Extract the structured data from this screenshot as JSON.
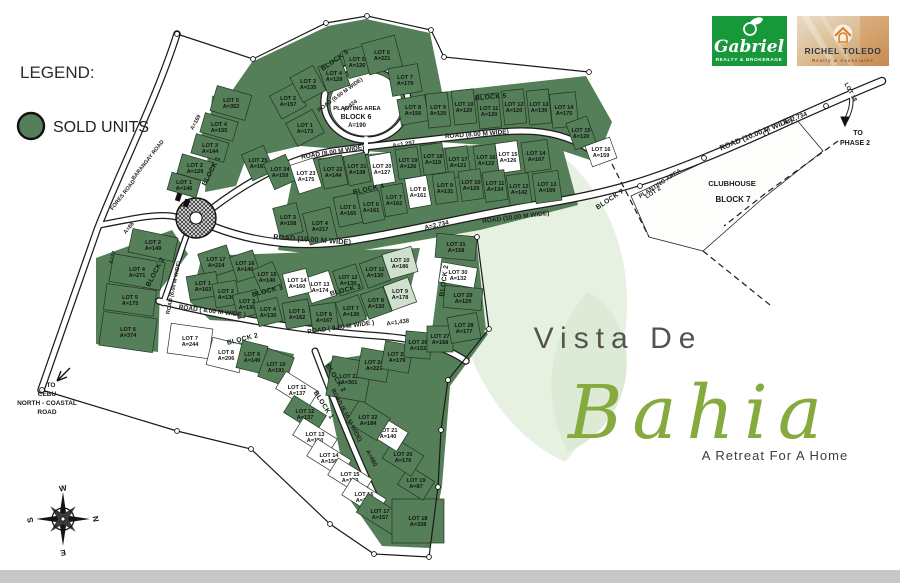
{
  "legend": {
    "title": "LEGEND:",
    "sold_label": "SOLD UNITS"
  },
  "branding": {
    "gabriel_name": "Gabriel",
    "gabriel_tagline": "REALTY & BROKERAGE",
    "richel_name": "RICHEL TOLEDO",
    "richel_tagline": "Realty & Associates"
  },
  "title": {
    "prefix": "Vista De",
    "name": "Bahia",
    "tagline": "A Retreat For A Home"
  },
  "compass": {
    "n": "N",
    "e": "E",
    "s": "S",
    "w": "W"
  },
  "colors": {
    "sold": "#547f58",
    "pale": "#cfe0cc",
    "open": "#ffffff",
    "leaf": "#e3eedd",
    "gabriel_green": "#17993b",
    "road_casing": "#1c1c1c",
    "title_gray": "#57524d",
    "title_green": "#85aa3e"
  },
  "map": {
    "blocks": [
      {
        "id": "block-5",
        "lots": [
          [
            1,
            173,
            305,
            128,
            1,
            30,
            26,
            -28
          ],
          [
            2,
            157,
            288,
            101,
            1,
            28,
            26,
            -28
          ],
          [
            3,
            135,
            308,
            84,
            1,
            26,
            28,
            -28
          ],
          [
            4,
            129,
            334,
            76,
            1,
            24,
            28,
            -20
          ],
          [
            5,
            126,
            357,
            62,
            1,
            24,
            28,
            -15
          ],
          [
            6,
            221,
            382,
            55,
            1,
            34,
            32,
            -15
          ],
          [
            7,
            179,
            405,
            80,
            1,
            30,
            28,
            -10
          ],
          [
            8,
            156,
            413,
            110,
            1,
            28,
            26,
            -10
          ],
          [
            9,
            120,
            438,
            110,
            1,
            22,
            34,
            -6
          ],
          [
            10,
            120,
            464,
            107,
            1,
            22,
            34,
            -6
          ],
          [
            11,
            120,
            489,
            111,
            1,
            22,
            34,
            -6
          ],
          [
            12,
            120,
            514,
            107,
            1,
            22,
            34,
            -6
          ],
          [
            13,
            130,
            539,
            107,
            1,
            22,
            34,
            -6
          ],
          [
            14,
            175,
            564,
            110,
            1,
            26,
            34,
            -6
          ],
          [
            15,
            120,
            581,
            133,
            1,
            22,
            28,
            -20
          ],
          [
            16,
            159,
            601,
            152,
            0,
            26,
            22,
            -20
          ]
        ]
      },
      {
        "id": "block-4",
        "lots": [
          [
            25,
            161,
            258,
            163,
            1,
            24,
            28,
            -24
          ],
          [
            24,
            159,
            280,
            172,
            1,
            24,
            28,
            -24
          ],
          [
            23,
            175,
            306,
            176,
            0,
            24,
            30,
            -18
          ],
          [
            22,
            144,
            333,
            172,
            1,
            24,
            30,
            -12
          ],
          [
            21,
            138,
            357,
            169,
            1,
            22,
            30,
            -12
          ],
          [
            20,
            127,
            382,
            169,
            0,
            22,
            30,
            -10
          ],
          [
            19,
            126,
            408,
            163,
            1,
            22,
            30,
            -8
          ],
          [
            18,
            119,
            433,
            159,
            1,
            22,
            30,
            -8
          ],
          [
            17,
            121,
            458,
            162,
            1,
            22,
            30,
            -8
          ],
          [
            16,
            122,
            486,
            160,
            1,
            22,
            30,
            -8
          ],
          [
            15,
            126,
            508,
            157,
            0,
            22,
            30,
            -8
          ],
          [
            14,
            167,
            536,
            156,
            1,
            26,
            30,
            -8
          ],
          [
            3,
            158,
            288,
            220,
            1,
            24,
            30,
            -14
          ],
          [
            4,
            217,
            320,
            226,
            1,
            28,
            32,
            -14
          ],
          [
            5,
            165,
            348,
            210,
            1,
            24,
            30,
            -12
          ],
          [
            6,
            161,
            371,
            207,
            1,
            22,
            30,
            -12
          ],
          [
            7,
            162,
            394,
            200,
            1,
            22,
            30,
            -10
          ],
          [
            8,
            161,
            418,
            192,
            0,
            22,
            30,
            -10
          ],
          [
            9,
            131,
            445,
            188,
            1,
            22,
            30,
            -8
          ],
          [
            10,
            129,
            471,
            185,
            1,
            22,
            30,
            -8
          ],
          [
            11,
            134,
            495,
            186,
            1,
            22,
            30,
            -8
          ],
          [
            12,
            142,
            519,
            189,
            1,
            22,
            30,
            -8
          ],
          [
            13,
            169,
            547,
            187,
            1,
            26,
            30,
            -8
          ]
        ]
      },
      {
        "id": "block-1",
        "lots": [
          [
            5,
            352,
            231,
            103,
            1,
            36,
            26,
            16
          ],
          [
            4,
            155,
            219,
            127,
            1,
            34,
            20,
            16
          ],
          [
            3,
            144,
            210,
            148,
            1,
            34,
            20,
            16
          ],
          [
            2,
            129,
            195,
            168,
            1,
            32,
            20,
            16
          ],
          [
            1,
            146,
            184,
            185,
            1,
            30,
            18,
            16
          ]
        ]
      },
      {
        "id": "block-3",
        "lots": [
          [
            17,
            214,
            216,
            262,
            1,
            30,
            26,
            -18
          ],
          [
            16,
            140,
            245,
            266,
            1,
            24,
            26,
            -18
          ],
          [
            15,
            140,
            267,
            277,
            1,
            22,
            24,
            -24
          ],
          [
            1,
            163,
            203,
            286,
            1,
            30,
            24,
            -10
          ],
          [
            2,
            130,
            226,
            294,
            1,
            24,
            24,
            -10
          ],
          [
            3,
            130,
            247,
            304,
            1,
            24,
            24,
            -14
          ],
          [
            4,
            130,
            268,
            312,
            1,
            24,
            24,
            -14
          ],
          [
            5,
            162,
            297,
            314,
            1,
            26,
            26,
            -10
          ],
          [
            6,
            167,
            324,
            317,
            1,
            26,
            26,
            -8
          ],
          [
            7,
            130,
            351,
            311,
            1,
            24,
            26,
            -20
          ],
          [
            8,
            130,
            376,
            303,
            1,
            24,
            26,
            -20
          ],
          [
            9,
            178,
            400,
            294,
            2,
            26,
            26,
            -20
          ],
          [
            10,
            186,
            400,
            263,
            2,
            30,
            26,
            -16
          ],
          [
            11,
            130,
            375,
            272,
            1,
            24,
            26,
            -20
          ],
          [
            12,
            130,
            348,
            280,
            1,
            24,
            26,
            -18
          ],
          [
            13,
            174,
            320,
            287,
            0,
            26,
            26,
            -18
          ],
          [
            14,
            160,
            297,
            283,
            0,
            24,
            24,
            -14
          ]
        ]
      },
      {
        "id": "block-2",
        "lots": [
          [
            2,
            149,
            153,
            245,
            1,
            46,
            24,
            12
          ],
          [
            4,
            271,
            137,
            272,
            1,
            52,
            28,
            10
          ],
          [
            5,
            175,
            130,
            300,
            1,
            50,
            26,
            8
          ],
          [
            6,
            374,
            128,
            332,
            1,
            54,
            34,
            8
          ],
          [
            7,
            244,
            190,
            341,
            0,
            42,
            30,
            8
          ],
          [
            8,
            206,
            226,
            355,
            0,
            34,
            28,
            14
          ],
          [
            9,
            140,
            252,
            357,
            1,
            26,
            28,
            14
          ],
          [
            10,
            191,
            276,
            367,
            1,
            28,
            30,
            20
          ],
          [
            11,
            137,
            297,
            390,
            0,
            38,
            20,
            32
          ],
          [
            12,
            137,
            305,
            414,
            1,
            38,
            20,
            32
          ],
          [
            13,
            150,
            315,
            437,
            0,
            40,
            20,
            32
          ],
          [
            14,
            156,
            329,
            458,
            0,
            40,
            20,
            32
          ],
          [
            15,
            153,
            350,
            477,
            0,
            40,
            20,
            32
          ],
          [
            16,
            157,
            364,
            497,
            0,
            40,
            20,
            32
          ],
          [
            17,
            157,
            380,
            514,
            1,
            42,
            22,
            32
          ],
          [
            18,
            328,
            418,
            521,
            1,
            52,
            44,
            0
          ],
          [
            19,
            87,
            416,
            483,
            1,
            30,
            22,
            32
          ],
          [
            20,
            176,
            403,
            457,
            1,
            34,
            24,
            32
          ],
          [
            21,
            140,
            388,
            433,
            0,
            34,
            22,
            32
          ],
          [
            22,
            184,
            368,
            420,
            1,
            36,
            26,
            32
          ],
          [
            23,
            301,
            349,
            379,
            1,
            40,
            40,
            10
          ],
          [
            24,
            221,
            374,
            365,
            1,
            30,
            30,
            10
          ],
          [
            25,
            179,
            397,
            357,
            1,
            28,
            28,
            10
          ],
          [
            26,
            152,
            418,
            345,
            1,
            26,
            26,
            5
          ],
          [
            27,
            168,
            440,
            339,
            1,
            26,
            26,
            0
          ],
          [
            28,
            177,
            464,
            328,
            1,
            30,
            26,
            -10
          ],
          [
            29,
            129,
            463,
            298,
            1,
            38,
            22,
            5
          ],
          [
            30,
            132,
            458,
            275,
            0,
            36,
            20,
            10
          ],
          [
            31,
            158,
            456,
            247,
            1,
            40,
            24,
            5
          ]
        ]
      }
    ],
    "block_labels": [
      [
        "BLOCK 5",
        336,
        62,
        -35
      ],
      [
        "BLOCK 5",
        491,
        99,
        -5
      ],
      [
        "BLOCK 4",
        369,
        191,
        -12
      ],
      [
        "BLOCK 3",
        268,
        293,
        -14
      ],
      [
        "BLOCK 3",
        346,
        292,
        -14
      ],
      [
        "BLOCK 1",
        213,
        172,
        -62
      ],
      [
        "BLOCK 2",
        157,
        273,
        -62
      ],
      [
        "BLOCK 2",
        243,
        341,
        -14
      ],
      [
        "BLOCK 2",
        334,
        379,
        58
      ],
      [
        "BLOCK 1",
        322,
        406,
        58
      ],
      [
        "BLOCK 2",
        446,
        281,
        -82
      ],
      [
        "BLOCK 7",
        611,
        201,
        -33
      ]
    ],
    "road_labels": [
      [
        "ROAD (8.00 M WIDE)",
        333,
        154,
        -9,
        6.5
      ],
      [
        "A=1,297",
        404,
        146,
        -9,
        6
      ],
      [
        "ROAD (8.00 M WIDE)",
        477,
        136,
        -4,
        6.5
      ],
      [
        "ROAD (10.00 M WIDE)",
        757,
        136,
        -22,
        7.5
      ],
      [
        "A=2,734",
        796,
        120,
        -22,
        6.5
      ],
      [
        "ROAD (10.00 M WIDE)",
        312,
        242,
        4,
        7.5
      ],
      [
        "A=2,734",
        437,
        227,
        -13,
        6.5
      ],
      [
        "ROAD (10.00 M WIDE)",
        516,
        219,
        -7,
        6.5
      ],
      [
        "ROAD ( 8.00 M WIDE )",
        212,
        313,
        7,
        6.5
      ],
      [
        "ROAD ( 8.00 M WIDE )",
        341,
        329,
        -8,
        6.5
      ],
      [
        "A=1,438",
        398,
        324,
        -8,
        6
      ],
      [
        "ROAD (6.50 M WIDE)",
        345,
        416,
        62,
        6
      ],
      [
        "A=460",
        370,
        459,
        62,
        6
      ],
      [
        "ROAD (6.00 M WIDE)",
        175,
        288,
        -78,
        5.5
      ],
      [
        "ROAD (6.50 M WIDE)",
        341,
        96,
        -36,
        5.5
      ],
      [
        "A=424",
        351,
        107,
        -36,
        5.5
      ],
      [
        "BARANGAY ROAD",
        149,
        161,
        -52,
        5.5
      ],
      [
        "FORES ROAD",
        124,
        196,
        -52,
        5.5
      ],
      [
        "A=169",
        197,
        123,
        -62,
        5.5
      ],
      [
        "A=88",
        130,
        229,
        -52,
        5.5
      ],
      [
        "A=77",
        114,
        258,
        -72,
        5.5
      ],
      [
        "PLANTING AREA",
        661,
        185,
        -33,
        6
      ],
      [
        "LOT 2",
        654,
        194,
        -33,
        6
      ],
      [
        "LOT 18",
        849,
        93,
        62,
        6
      ]
    ],
    "float_labels": [
      [
        "CLUBHOUSE",
        732,
        186,
        7.5,
        0
      ],
      [
        "BLOCK 7",
        733,
        202,
        8,
        1
      ],
      [
        "PLANTING AREA",
        357,
        110,
        5.8,
        0
      ],
      [
        "BLOCK 6",
        356,
        119,
        7,
        1
      ],
      [
        "A=190",
        357,
        127,
        6,
        0
      ],
      [
        "TO",
        858,
        135,
        7,
        1
      ],
      [
        "PHASE 2",
        855,
        145,
        7,
        1
      ],
      [
        "TO",
        51,
        387,
        6.5,
        1
      ],
      [
        "CEBU",
        47,
        396,
        6.5,
        1
      ],
      [
        "NORTH - COASTAL",
        47,
        405,
        6.5,
        1
      ],
      [
        "ROAD",
        47,
        414,
        6.5,
        1
      ]
    ]
  }
}
